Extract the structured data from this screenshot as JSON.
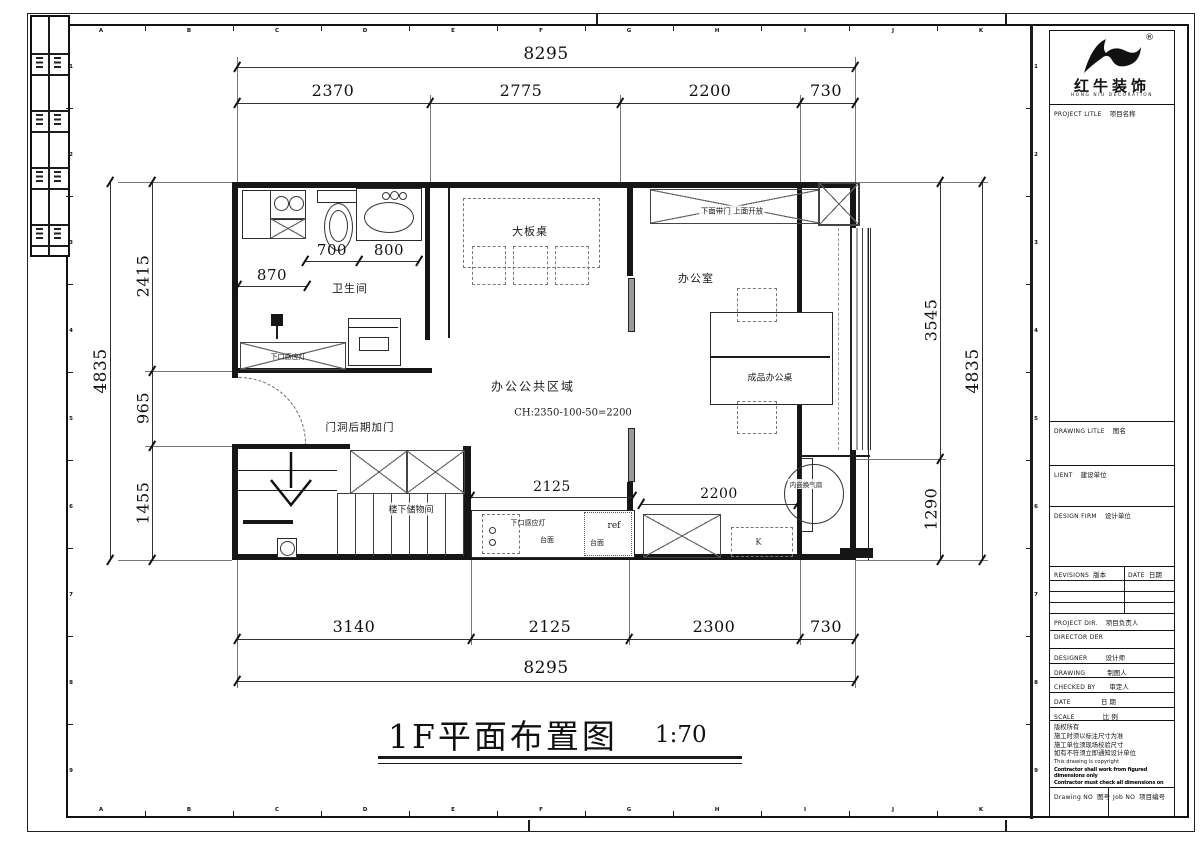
{
  "sheet": {
    "rulers": {
      "top_letters": [
        "A",
        "B",
        "C",
        "D",
        "E",
        "F",
        "G",
        "H",
        "I",
        "J",
        "K"
      ],
      "side_numbers": [
        "1",
        "2",
        "3",
        "4",
        "5",
        "6",
        "7",
        "8",
        "9"
      ]
    }
  },
  "plan_title": {
    "text": "1F平面布置图",
    "scale": "1:70"
  },
  "dimensions": {
    "top_total": "8295",
    "top_segments": [
      "2370",
      "2775",
      "2200",
      "730"
    ],
    "bottom_segments": [
      "3140",
      "2125",
      "2300",
      "730"
    ],
    "bottom_total": "8295",
    "left_outer": "4835",
    "left_segments": [
      "2415",
      "965",
      "1455"
    ],
    "right_segments": [
      "3545",
      "1290"
    ],
    "right_outer": "4835",
    "bath_segments": [
      "870",
      "700",
      "800"
    ],
    "counter_width": "2125",
    "kitchen_width": "2200"
  },
  "labels": {
    "bathroom": "卫生间",
    "sensor_light_bath": "下口感应灯",
    "door_note": "门洞后期加门",
    "storage": "楼下储物间",
    "big_table": "大板桌",
    "cabinet_note": "下面带门  上面开放",
    "office": "办公室",
    "office_desk": "成品办公桌",
    "public_area": "办公公共区域",
    "ceiling_note": "CH:2350-100-50=2200",
    "sensor_light_counter": "下口感应灯",
    "countertop_1": "台面",
    "countertop_2": "台面",
    "fridge": "ref",
    "kitchen": "K",
    "fan_note": "内嵌换气扇"
  },
  "title_block": {
    "brand": {
      "name": "红牛装饰",
      "sub": "HONG NIU DECORATION",
      "reg": "®"
    },
    "project": {
      "en": "PROJECT LITLE",
      "zh": "项目名称"
    },
    "drawing_title": {
      "en": "DRAWING LITLE",
      "zh": "图名"
    },
    "client": {
      "en": "LIENT",
      "zh": "建设单位"
    },
    "design_firm": {
      "en": "DESIGN FIRM",
      "zh": "设计单位"
    },
    "revisions": {
      "en": "REVISIONS",
      "zh": "版本"
    },
    "date_col": {
      "en": "DATE",
      "zh": "日期"
    },
    "project_dir": {
      "en": "PROJECT DIR.",
      "zh": "项目负责人"
    },
    "director": {
      "en": "DIRECTOR DER",
      "zh": ""
    },
    "designer": {
      "en": "DESIGNER",
      "zh": "设计师"
    },
    "drawing_by": {
      "en": "DRAWING",
      "zh": "制图人"
    },
    "checked_by": {
      "en": "CHECKED BY",
      "zh": "审定人"
    },
    "date_row": {
      "en": "DATE",
      "zh": "日 期"
    },
    "scale_row": {
      "en": "SCALE",
      "zh": "比 例"
    },
    "copyright_lines": [
      "版权所有",
      "施工时须以标注尺寸为准",
      "施工单位须现场校验尺寸",
      "如有不符须立即通知设计单位",
      "This drawing is copyright"
    ],
    "copyright_bold": [
      "Contractor shall work from figured dimensions only",
      "Contractor must check all dimensions on site",
      "Contractor must be reported immediately to architects"
    ],
    "drawing_no": {
      "en": "Drawing NO",
      "zh": "图号"
    },
    "job_no": {
      "en": "Job NO",
      "zh": "项目编号"
    }
  }
}
